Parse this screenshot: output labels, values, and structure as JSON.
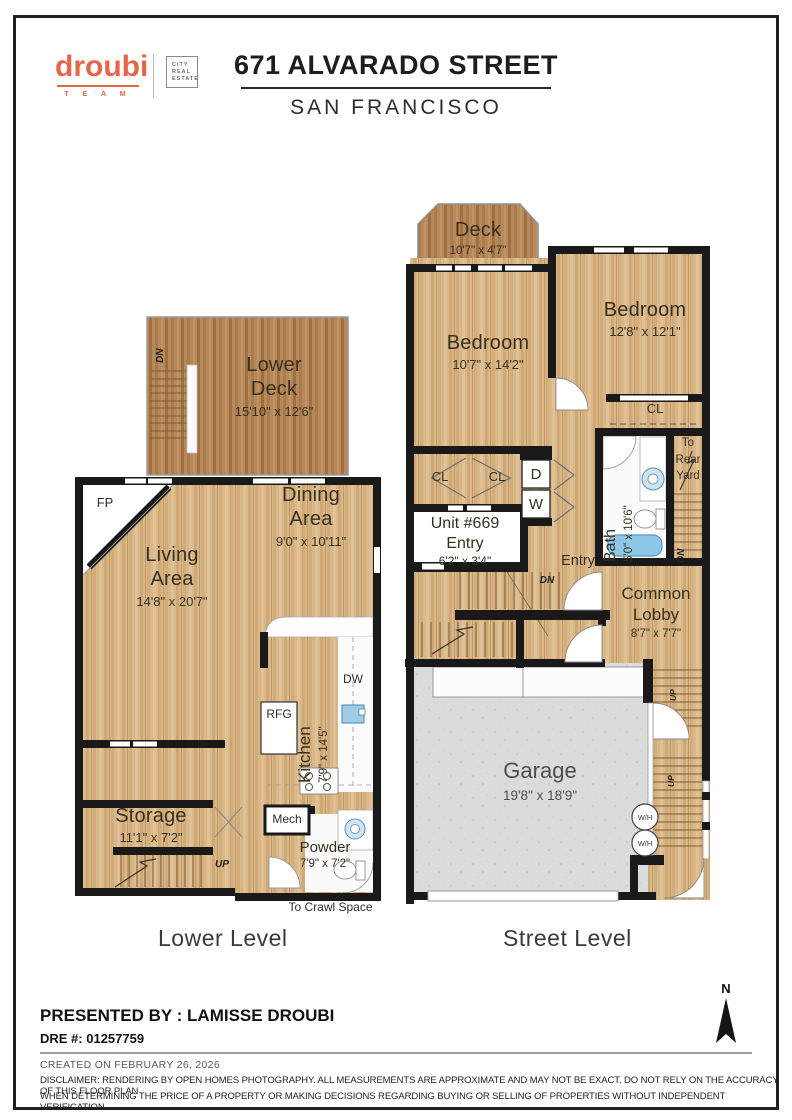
{
  "header": {
    "brand": "droubi",
    "brand_team": "T E A M",
    "brand_box": "CITY\nREAL\nESTATE",
    "title": "671 ALVARADO STREET",
    "subtitle": "SAN FRANCISCO"
  },
  "plans": {
    "lower": {
      "label": "Lower Level",
      "rooms": {
        "deck": {
          "name1": "Lower",
          "name2": "Deck",
          "dims": "15'10\" x 12'6\""
        },
        "living": {
          "name1": "Living",
          "name2": "Area",
          "dims": "14'8\" x 20'7\""
        },
        "dining": {
          "name1": "Dining",
          "name2": "Area",
          "dims": "9'0\" x 10'11\""
        },
        "kitchen": {
          "name": "Kitchen",
          "dims": "7'9\" x 14'5\""
        },
        "storage": {
          "name": "Storage",
          "dims": "11'1\" x 7'2\""
        },
        "powder": {
          "name": "Powder",
          "dims": "7'9\" x 7'2\""
        }
      },
      "notes": {
        "crawl": "To  Crawl Space"
      }
    },
    "street": {
      "label": "Street Level",
      "rooms": {
        "deck": {
          "name": "Deck",
          "dims": "10'7\" x 4'7\""
        },
        "bedroom1": {
          "name": "Bedroom",
          "dims": "10'7\" x 14'2\""
        },
        "bedroom2": {
          "name": "Bedroom",
          "dims": "12'8\" x 12'1\""
        },
        "bath": {
          "name": "Bath",
          "dims": "5'0\" x 10'6\""
        },
        "unit_entry": {
          "line1": "Unit #669",
          "line2": "Entry",
          "dims": "6'2\" x 3'4\""
        },
        "lobby": {
          "name1": "Common",
          "name2": "Lobby",
          "dims": "8'7\" x 7'7\""
        },
        "garage": {
          "name": "Garage",
          "dims": "19'8\" x 18'9\""
        }
      },
      "notes": {
        "rear1": "To",
        "rear2": "Rear",
        "rear3": "Yard"
      }
    }
  },
  "labels": {
    "cl": "CL",
    "d": "D",
    "w": "W",
    "dn": "DN",
    "up": "UP",
    "fp": "FP",
    "rfg": "RFG",
    "dw": "DW",
    "mech": "Mech",
    "wh": "W/H",
    "entry": "Entry"
  },
  "compass": {
    "n": "N"
  },
  "footer": {
    "presented_by": "PRESENTED BY : LAMISSE DROUBI",
    "dre": "DRE #: 01257759",
    "created": "CREATED ON FEBRUARY 26, 2026",
    "disclaimer": [
      "DISCLAIMER: RENDERING BY OPEN HOMES PHOTOGRAPHY. ALL MEASUREMENTS ARE APPROXIMATE AND MAY NOT BE EXACT. DO NOT RELY ON THE ACCURACY OF THIS FLOOR PLAN",
      "WHEN DETERMINING THE PRICE OF A PROPERTY OR MAKING DECISIONS REGARDING BUYING OR SELLING OF PROPERTIES WITHOUT INDEPENDENT VERIFICATION."
    ]
  },
  "colors": {
    "accent": "#e4674a",
    "wood": "#d8b586",
    "deck_wood": "#b5875a",
    "garage": "#d9dcdb",
    "wall": "#191919",
    "tub": "#8ec8e9"
  }
}
